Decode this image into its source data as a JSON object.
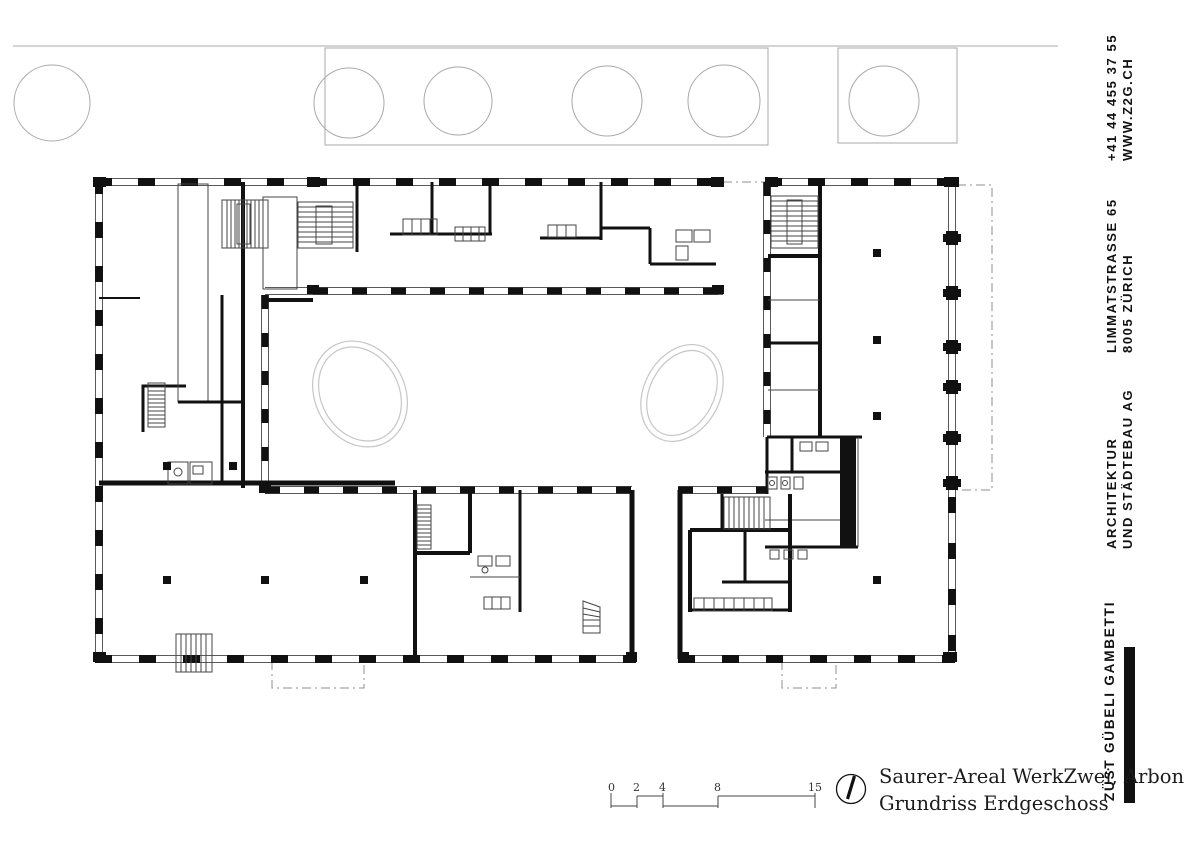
{
  "document": {
    "project_title": "Saurer-Areal WerkZwei, Arbon",
    "drawing_title": "Grundriss Erdgeschoss"
  },
  "scale_bar": {
    "labels": [
      "0",
      "2",
      "4",
      "8",
      "15"
    ]
  },
  "sidebar": {
    "contact": {
      "line1": "+41 44 455 37 55",
      "line2": "WWW.Z2G.CH"
    },
    "address": {
      "line1": "LIMMATSTRASSE 65",
      "line2": "8005 ZÜRICH"
    },
    "firm_type": {
      "line1": "ARCHITEKTUR",
      "line2": "UND STÄDTEBAU AG"
    },
    "firm_name": "ZÜST GÜBELI GAMBETTI",
    "accent_color": "#111111"
  },
  "plan": {
    "ink_color": "#111111",
    "context_color": "#a9a9a9",
    "pond_color": "#c6c6c6"
  }
}
